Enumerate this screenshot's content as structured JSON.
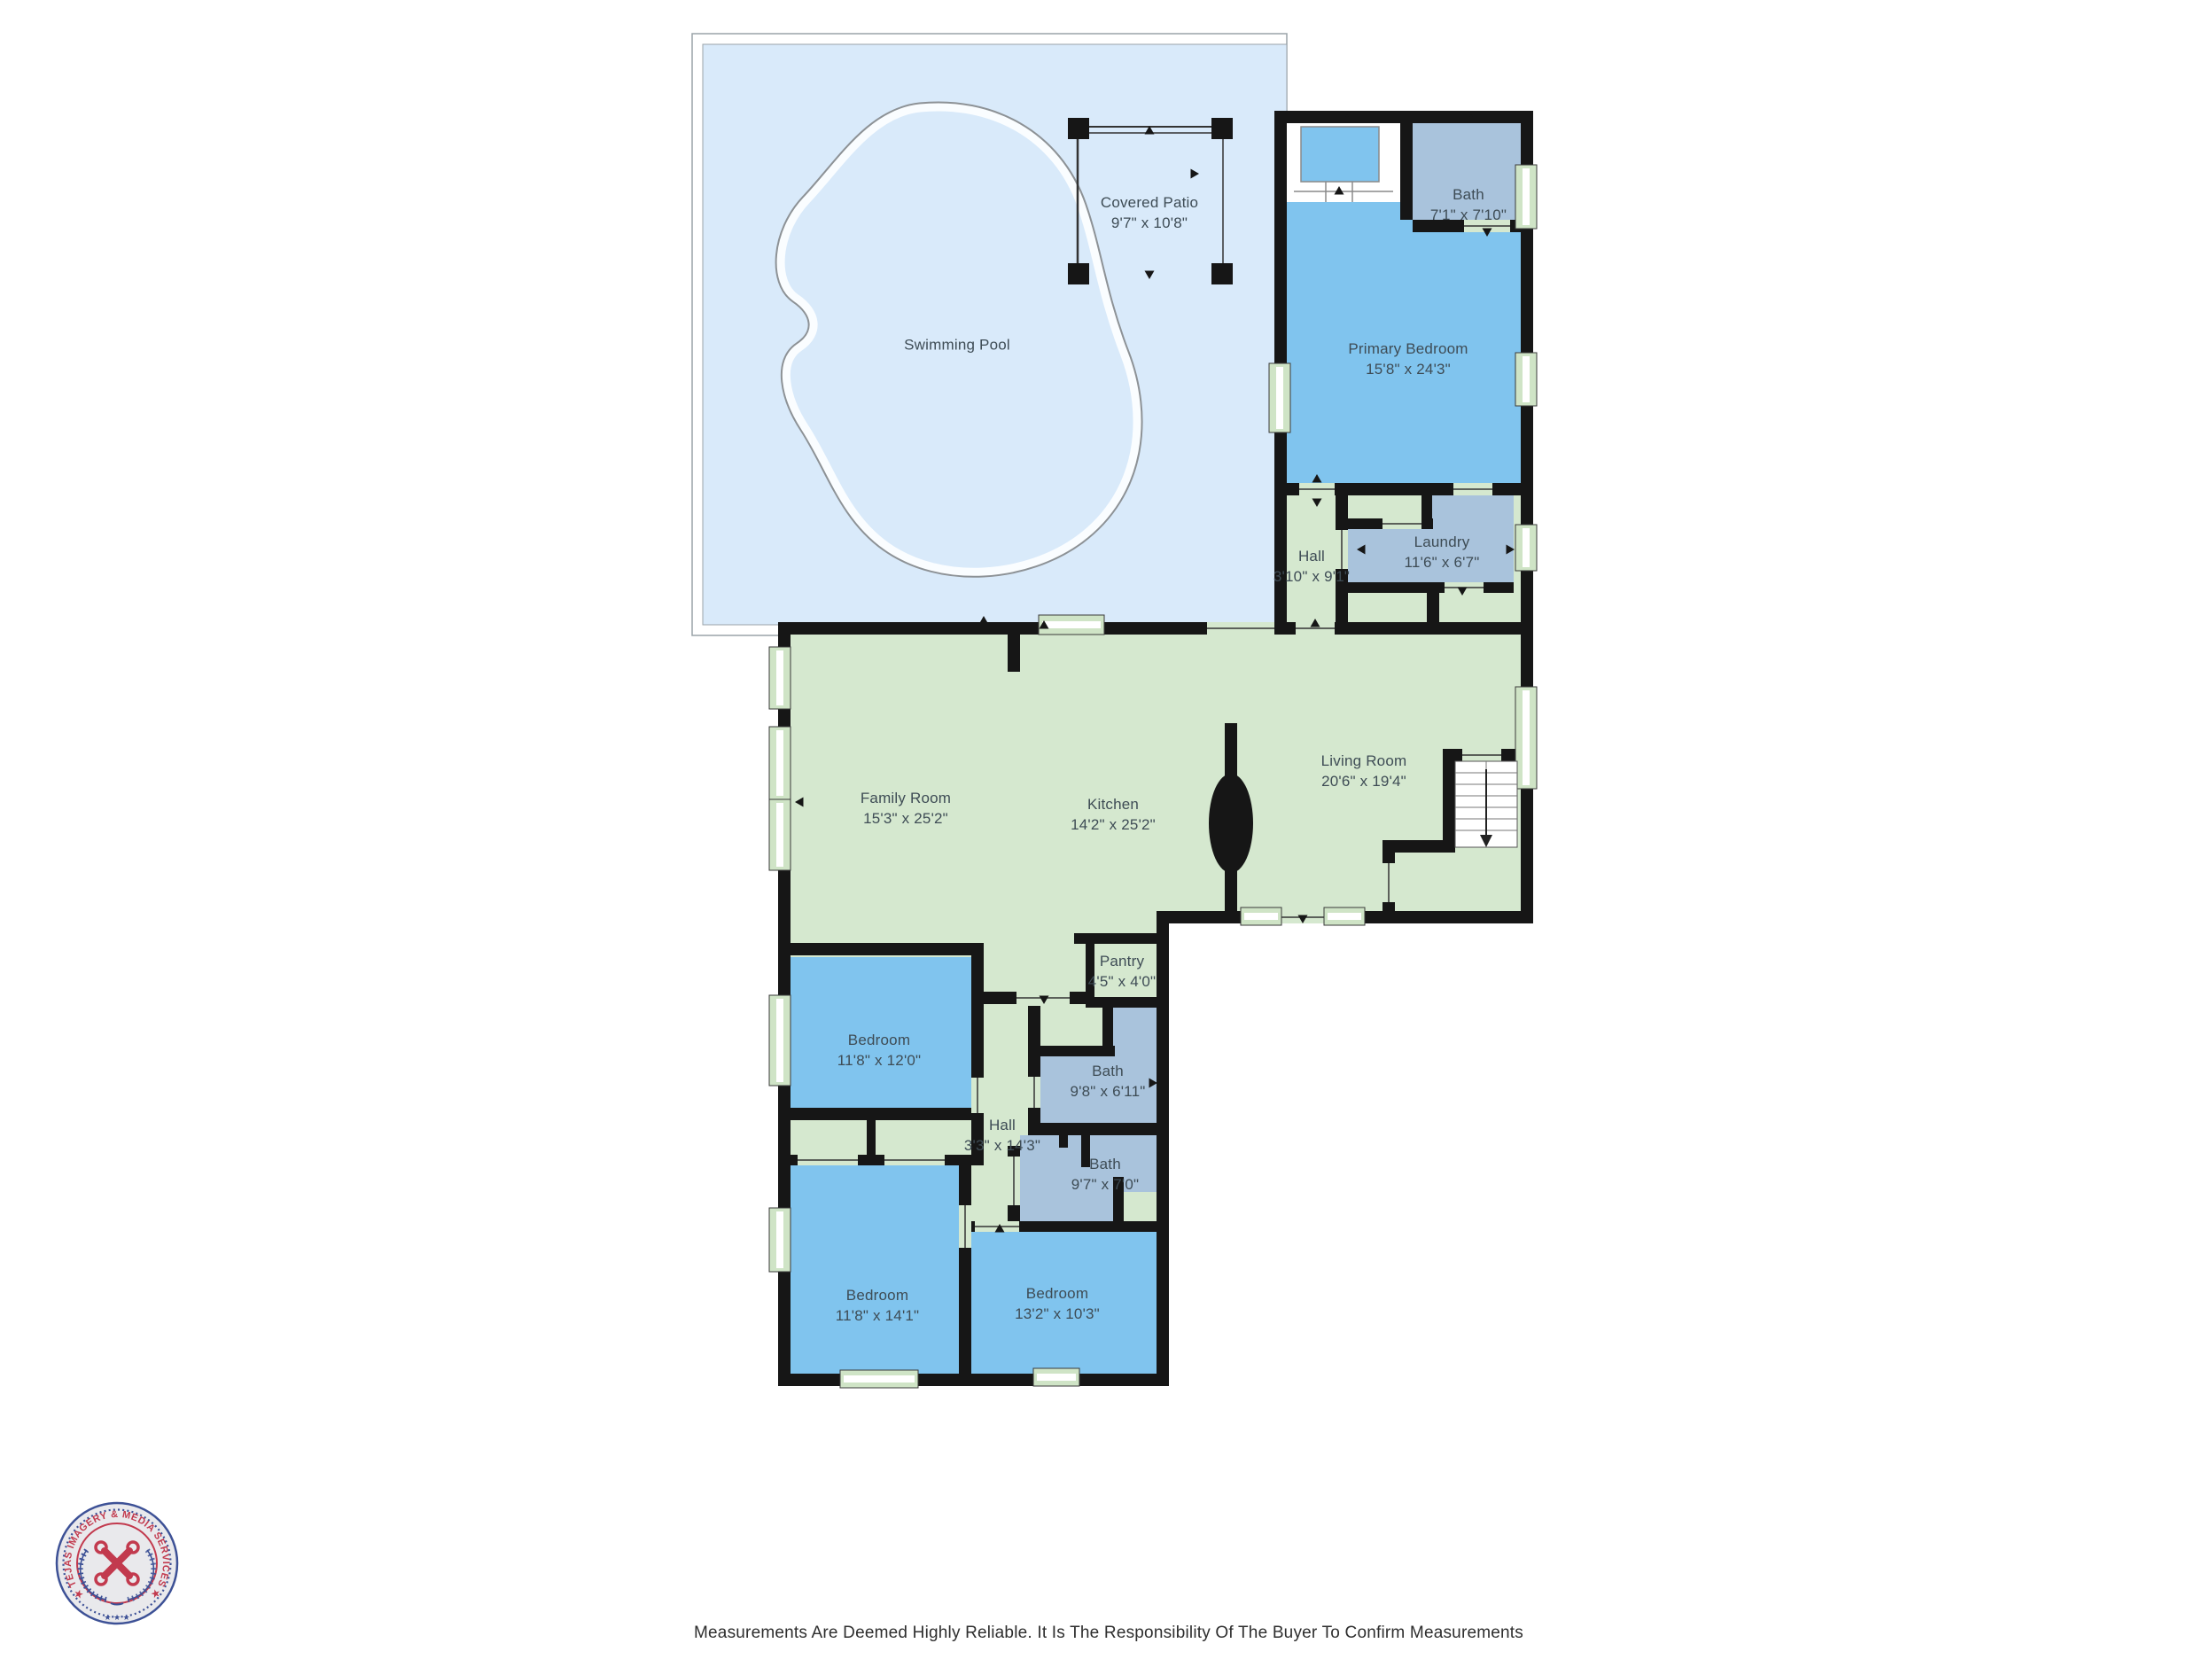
{
  "colors": {
    "pool_blue": "#d9eafa",
    "room_green": "#d5e8cf",
    "room_blue": "#80c4ee",
    "room_gray_blue": "#a9c3dc",
    "window_green": "#cfe4c6",
    "wall_black": "#161616",
    "label_text": "#3e4c55",
    "logo_red": "#c23a4e",
    "logo_blue": "#3d5196"
  },
  "rooms": [
    {
      "name": "Covered Patio",
      "dims": "9'7\" x 10'8\""
    },
    {
      "name": "Swimming Pool",
      "dims": ""
    },
    {
      "name": "Bath",
      "dims": "7'1\" x 7'10\""
    },
    {
      "name": "Primary Bedroom",
      "dims": "15'8\" x 24'3\""
    },
    {
      "name": "Hall",
      "dims": "3'10\" x 9'1\""
    },
    {
      "name": "Laundry",
      "dims": "11'6\" x 6'7\""
    },
    {
      "name": "Living Room",
      "dims": "20'6\" x 19'4\""
    },
    {
      "name": "Family Room",
      "dims": "15'3\" x 25'2\""
    },
    {
      "name": "Kitchen",
      "dims": "14'2\" x 25'2\""
    },
    {
      "name": "Pantry",
      "dims": "4'5\" x 4'0\""
    },
    {
      "name": "Bedroom",
      "dims": "11'8\" x 12'0\""
    },
    {
      "name": "Bath",
      "dims": "9'8\" x 6'11\""
    },
    {
      "name": "Hall",
      "dims": "3'3\" x 14'3\""
    },
    {
      "name": "Bath",
      "dims": "9'7\" x 7'0\""
    },
    {
      "name": "Bedroom",
      "dims": "11'8\" x 14'1\""
    },
    {
      "name": "Bedroom",
      "dims": "13'2\" x 10'3\""
    }
  ],
  "footer": {
    "disclaimer": "Measurements Are Deemed Highly Reliable. It Is The Responsibility Of The Buyer To Confirm Measurements"
  },
  "logo": {
    "arc_text": "★ TEJAS IMAGERY & MEDIA SERVICES ★",
    "stars": "★ ★ ★"
  }
}
